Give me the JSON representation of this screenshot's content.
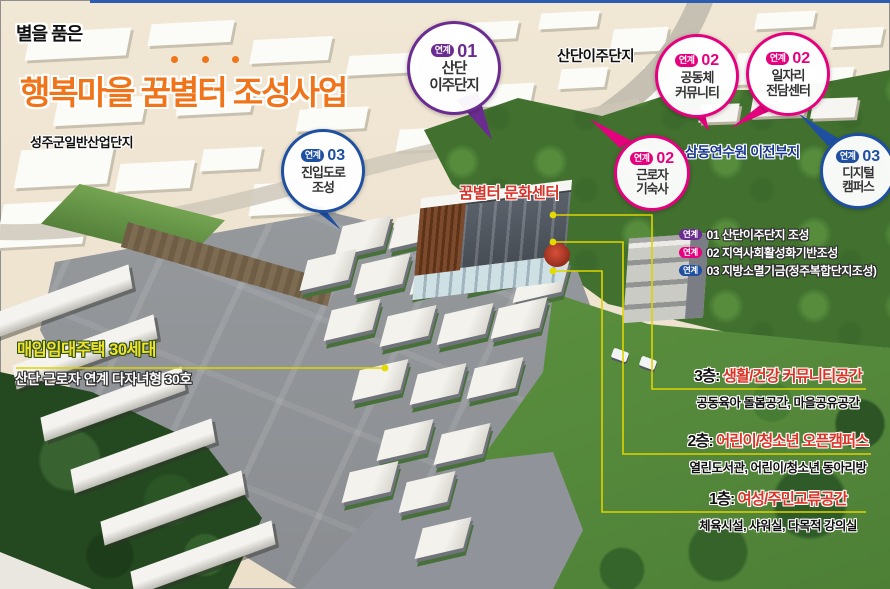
{
  "title": {
    "tagline": "별을 품은",
    "main": "행복마을 꿈별터 조성사업",
    "accent_color": "#f07419"
  },
  "map_labels": {
    "industrial_complex": "성주군일반산업단지",
    "relocation_complex": "산단이주단지",
    "training_center_site": "삼동연수원 이전부지",
    "culture_center": "꿈별터 문화센터"
  },
  "housing_label": {
    "title": "매입임대주택 30세대",
    "subtitle": "산단 근로자 연계 다자녀형 30호"
  },
  "callouts": [
    {
      "badge": "연계",
      "number": "01",
      "lines": [
        "산단",
        "이주단지"
      ],
      "color": "#6b2c91"
    },
    {
      "badge": "연계",
      "number": "02",
      "lines": [
        "공동체",
        "커뮤니티"
      ],
      "color": "#e5007e"
    },
    {
      "badge": "연계",
      "number": "02",
      "lines": [
        "일자리",
        "전담센터"
      ],
      "color": "#e5007e"
    },
    {
      "badge": "연계",
      "number": "03",
      "lines": [
        "진입도로",
        "조성"
      ],
      "color": "#1e4fa1"
    },
    {
      "badge": "연계",
      "number": "02",
      "lines": [
        "근로자",
        "기숙사"
      ],
      "color": "#e5007e"
    },
    {
      "badge": "연계",
      "number": "03",
      "lines": [
        "디지털",
        "캠퍼스"
      ],
      "color": "#1e4fa1"
    }
  ],
  "legend": {
    "items": [
      {
        "badge": "연계",
        "text": "01 산단이주단지 조성",
        "color": "#6b2c91"
      },
      {
        "badge": "연계",
        "text": "02 지역사회활성화기반조성",
        "color": "#e5007e"
      },
      {
        "badge": "연계",
        "text": "03 지방소멸기금(정주복합단지조성)",
        "color": "#1e4fa1"
      }
    ]
  },
  "floors": [
    {
      "level": "3층:",
      "name": "생활/건강 커뮤니티공간",
      "desc": "공동육아 돌봄공간, 마을공유공간"
    },
    {
      "level": "2층:",
      "name": "어린이/청소년 오픈캠퍼스",
      "desc": "열린도서관, 어린이/청소년 동아리방"
    },
    {
      "level": "1층:",
      "name": "여성/주민교류공간",
      "desc": "체육시설, 샤워실, 다목적 강의실"
    }
  ],
  "colors": {
    "title_orange": "#f07419",
    "link01_purple": "#6b2c91",
    "link02_pink": "#e5007e",
    "link03_blue": "#1e4fa1",
    "floor_red": "#da3427",
    "connector_yellow": "#ded400",
    "site_navy": "#16368f"
  }
}
